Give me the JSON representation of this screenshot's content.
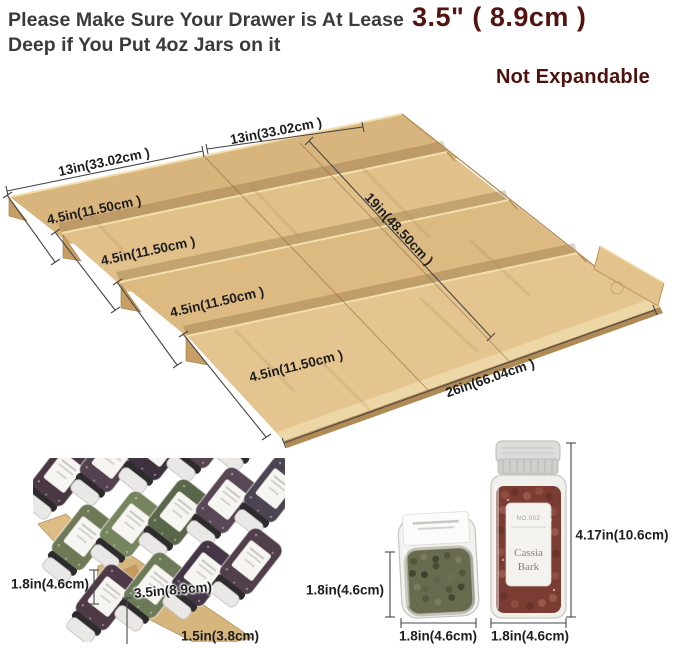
{
  "title": {
    "line1_prefix": "Please Make Sure Your Drawer is At Lease",
    "line1_highlight": "3.5\" ( 8.9cm )",
    "line2": "Deep if You Put 4oz Jars on it"
  },
  "badge": {
    "not_expandable": "Not Expandable"
  },
  "diagram": {
    "width_left_label": "13in(33.02cm )",
    "width_right_label": "13in(33.02cm )",
    "tier_labels": [
      "4.5in(11.50cm )",
      "4.5in(11.50cm )",
      "4.5in(11.50cm )",
      "4.5in(11.50cm )"
    ],
    "depth_label": "19in(48.50cm )",
    "total_width_label": "26in(66.04cm )"
  },
  "photo_inset": {
    "jar_height_label": "1.8in(4.6cm)",
    "tier_width_label": "3.5in(8.9cm)",
    "base_height_label": "1.5in(3.8cm)"
  },
  "jar_small": {
    "height_label": "1.8in(4.6cm)",
    "width_label": "1.8in(4.6cm)"
  },
  "jar_large": {
    "height_label": "4.17in(10.6cm)",
    "width_label": "1.8in(4.6cm)",
    "sticker_no": "NO.002",
    "sticker_line1": "Cassia",
    "sticker_line2": "Bark"
  },
  "colors": {
    "accent_maroon": "#4c120d",
    "text_dark": "#3a3a3a",
    "bamboo_light": "#e5c58f",
    "bamboo_mid": "#d9b57e",
    "bamboo_dark": "#b28a52",
    "dim_line": "#474747"
  }
}
